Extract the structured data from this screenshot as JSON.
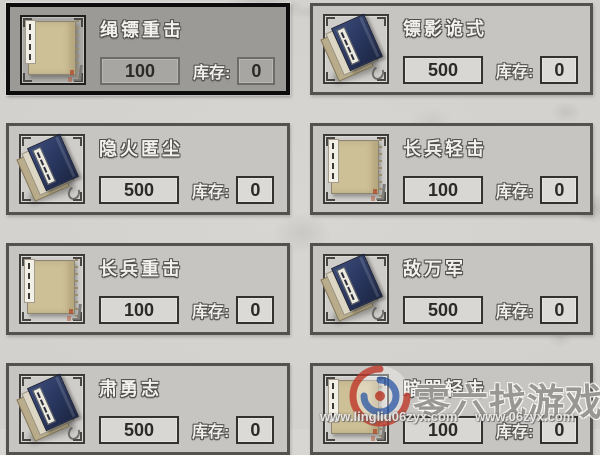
{
  "shop": {
    "stock_label": "库存:",
    "items": [
      {
        "name": "绳镖重击",
        "price": "100",
        "stock": "0",
        "icon": "tan-book",
        "selected": true
      },
      {
        "name": "镖影诡式",
        "price": "500",
        "stock": "0",
        "icon": "blue-books",
        "selected": false
      },
      {
        "name": "隐火匿尘",
        "price": "500",
        "stock": "0",
        "icon": "blue-books",
        "selected": false
      },
      {
        "name": "长兵轻击",
        "price": "100",
        "stock": "0",
        "icon": "tan-book",
        "selected": false
      },
      {
        "name": "长兵重击",
        "price": "100",
        "stock": "0",
        "icon": "tan-book",
        "selected": false
      },
      {
        "name": "敌万军",
        "price": "500",
        "stock": "0",
        "icon": "blue-books",
        "selected": false
      },
      {
        "name": "肃勇志",
        "price": "500",
        "stock": "0",
        "icon": "blue-books",
        "selected": false
      },
      {
        "name": "暗器轻击",
        "price": "100",
        "stock": "0",
        "icon": "tan-book",
        "selected": false
      }
    ]
  },
  "watermark": {
    "site_name": "零六找游戏",
    "url_left": "www.lingliu06zyx.com",
    "url_right": "www.06zyx.com"
  },
  "colors": {
    "page_bg": "#d8d6d2",
    "card_bg": "#c7c5c1",
    "selected_card_bg": "#9c9a96",
    "selected_border": "#0c0c0c",
    "box_border": "#34322e",
    "book_tan": "#cdbf96",
    "book_navy": "#2b3a63",
    "logo_red": "#c03a2c",
    "logo_blue": "#3a64ae"
  }
}
